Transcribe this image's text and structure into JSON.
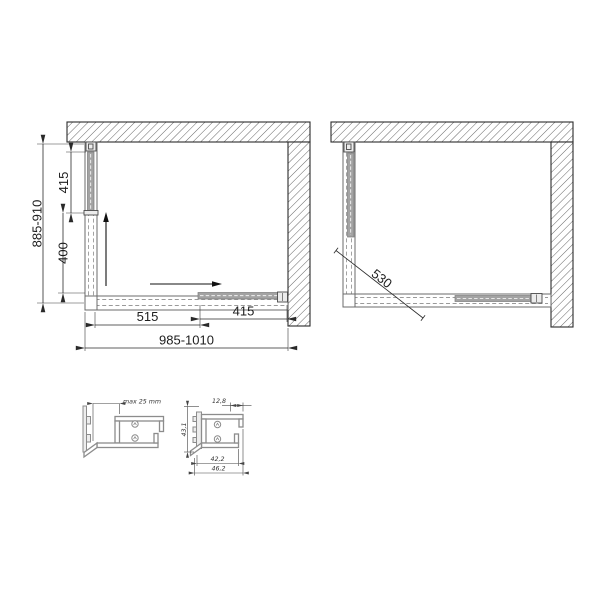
{
  "plan_closed": {
    "depth_overall": "885-910",
    "side_door": "415",
    "side_fixed": "400",
    "front_fixed": "515",
    "front_door": "415",
    "width_overall": "985-1010"
  },
  "plan_open": {
    "entry_diagonal": "530"
  },
  "wall_profile_detail": {
    "adjustment": "max 25 mm"
  },
  "frame_profile_detail": {
    "top_width": "12,8",
    "inner_width": "42,2",
    "outer_width": "46,2",
    "height": "43,1"
  },
  "colors": {
    "line": "#2a2a2a",
    "profile_gray": "#8c8c8c",
    "door_fill": "#a3a3a3",
    "hatch_line": "#555555",
    "background": "#ffffff"
  }
}
